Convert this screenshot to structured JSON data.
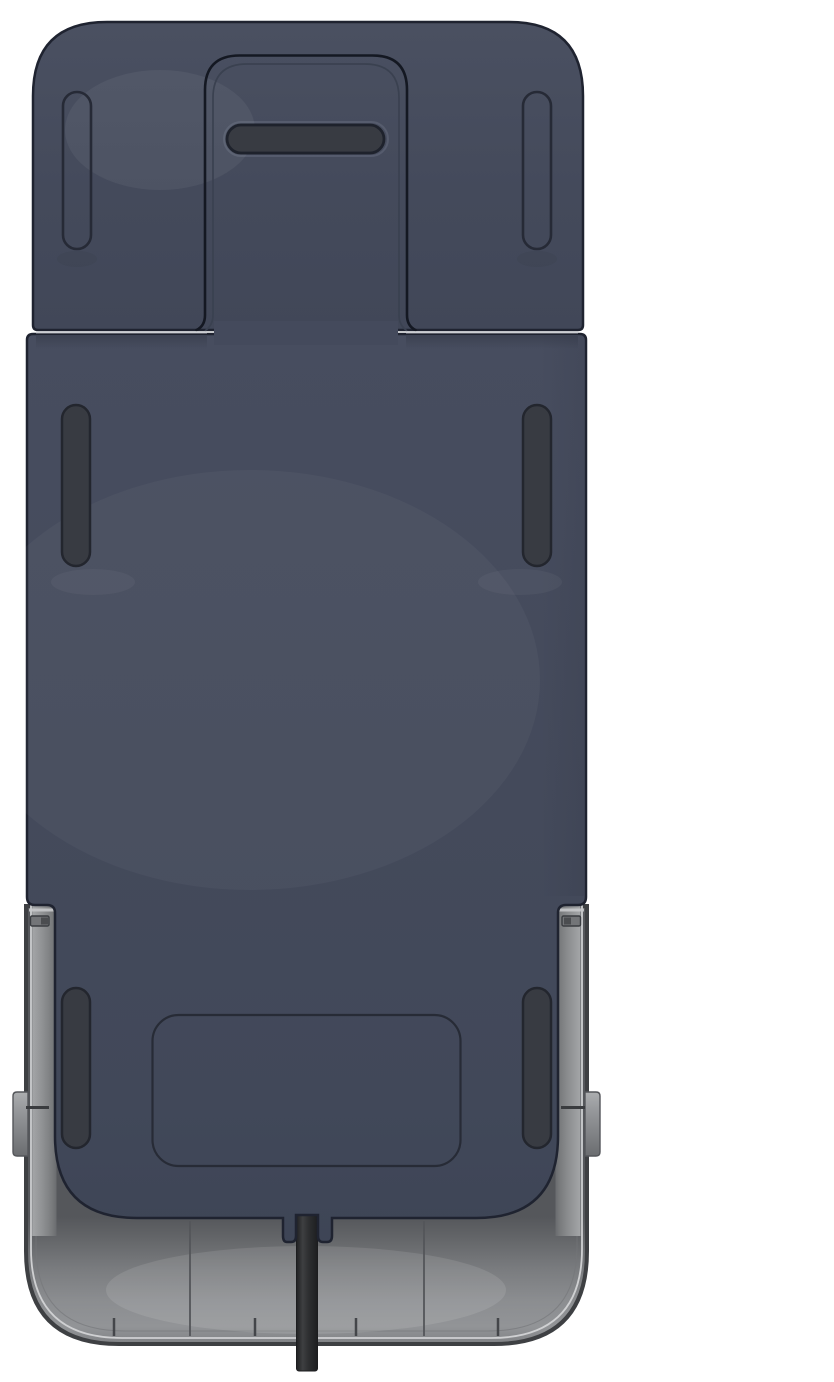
{
  "scene": {
    "type": "3d-product-render",
    "description": "Top-down render of a rectangular navy-blue device chassis seated in a gray base shell, with pill-shaped slots, a recessed handle panel at top, two side mounting tabs, and a black cable exiting through a notch at the bottom center.",
    "background_color": "#ffffff"
  },
  "palette": {
    "body_navy": "#444a5c",
    "cap_navy": "#454b5d",
    "outline_dark": "#1f2330",
    "slot_fill": "#383b42",
    "slot_border": "#23262e",
    "shell_gray_light": "#8f9193",
    "shell_gray_dark": "#55575b",
    "shell_rim_highlight": "#cfd0d2",
    "rail_highlight": "#b5b6b8",
    "tab_gray": "#8e9092",
    "cable_black": "#2b2c2e",
    "seam_light": "#cdcfd4"
  },
  "components": {
    "top_cap": {
      "label": "top cap panel",
      "outline_pill_slots": 2,
      "handle_slots": 1
    },
    "handle_slot": {
      "label": "horizontal handle slot",
      "shape": "rounded pill"
    },
    "main_body": {
      "label": "main body panel",
      "filled_pill_slots": 4,
      "inset_panel_outlines": 1
    },
    "base_shell": {
      "label": "gray base shell",
      "side_rails": 2,
      "seam_lines": 2,
      "rim_tick_marks": 4
    },
    "side_tabs": {
      "label": "side mounting tabs",
      "left": 1,
      "right": 1,
      "pins": 2
    },
    "cable": {
      "label": "power cable",
      "exit": "bottom center notch",
      "color": "#2b2c2e"
    }
  }
}
